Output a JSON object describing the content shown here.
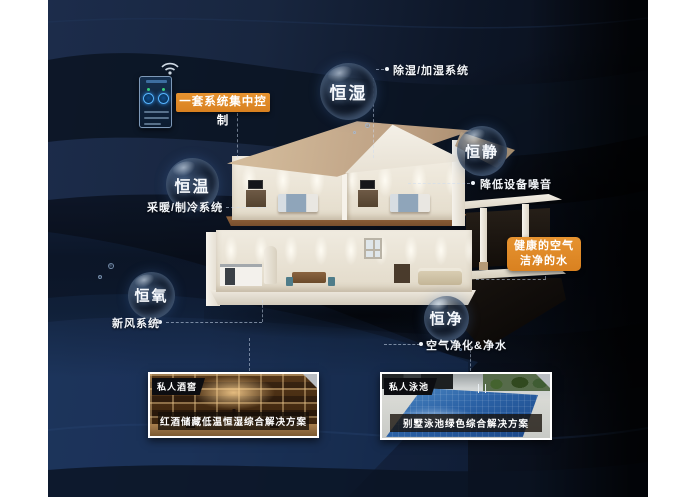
{
  "poster": {
    "control_callout": "一套系统集中控制",
    "healthy_callout": {
      "line1": "健康的空气",
      "line2": "洁净的水"
    }
  },
  "bubbles": [
    {
      "label": "恒湿",
      "desc": "除湿/加湿系统"
    },
    {
      "label": "恒静",
      "desc": "降低设备噪音"
    },
    {
      "label": "恒温",
      "desc": "采暖/制冷系统"
    },
    {
      "label": "恒氧",
      "desc": "新风系统"
    },
    {
      "label": "恒净",
      "desc": "空气净化&净水"
    }
  ],
  "photos": [
    {
      "tag": "私人酒窖",
      "caption": "红酒储藏低温恒湿综合解决方案"
    },
    {
      "tag": "私人泳池",
      "caption": "别墅泳池绿色综合解决方案"
    }
  ],
  "icons": {
    "wifi": "wifi-icon",
    "dial": "dial-icon"
  },
  "colors": {
    "accent_orange": "#E08A26",
    "background_navy": "#16233C",
    "panel_blue": "#10223C",
    "band_blue": "#1E3C6A",
    "pool_blue": "#2B62A6",
    "photo_border": "#FFFFFF",
    "bubble_text": "#F6F9FD"
  }
}
